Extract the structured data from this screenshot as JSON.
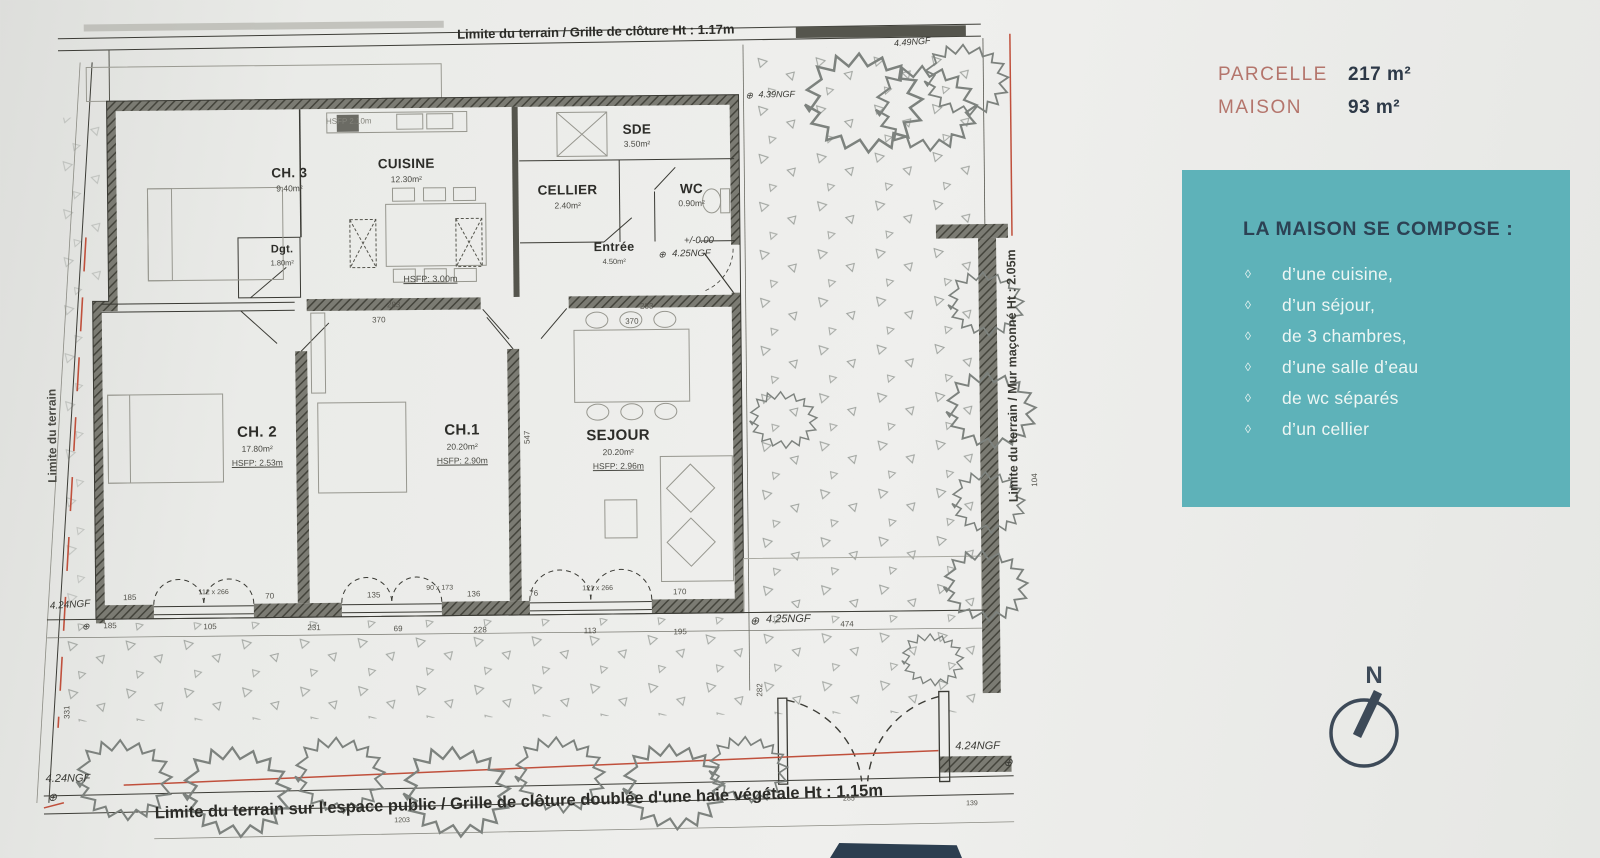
{
  "plan": {
    "boundary": {
      "top": "Limite du terrain / Grille de clôture Ht : 1.17m",
      "bottom": "Limite du terrain sur l'espace public / Grille de clôture doublée d'une haie végétale Ht : 1.15m",
      "left": "Limite du terrain",
      "right": "Limite du terrain / Mur maçonné Ht : 2.05m"
    },
    "rooms": [
      {
        "name": "CH. 3",
        "area": "9.40m²"
      },
      {
        "name": "Dgt.",
        "area": "1.80m²"
      },
      {
        "name": "CUISINE",
        "area": "12.30m²"
      },
      {
        "name": "CELLIER",
        "area": "2.40m²"
      },
      {
        "name": "SDE",
        "area": "3.50m²"
      },
      {
        "name": "WC",
        "area": "0.90m²"
      },
      {
        "name": "Entrée",
        "area": "4.50m²",
        "level": "+/-0.00",
        "ngf": "4.25NGF"
      },
      {
        "name": "CH. 2",
        "area": "17.80m²",
        "hsfp": "HSFP: 2.53m"
      },
      {
        "name": "CH.1",
        "area": "20.20m²",
        "hsfp": "HSFP: 2.90m"
      },
      {
        "name": "SEJOUR",
        "area": "20.20m²",
        "hsfp": "HSFP: 2.96m"
      }
    ],
    "hsfp_upper": "HSFP: 3.00m",
    "hsfp_kitchen": "HSFP 2.10m",
    "ngf_symbol": "⊕",
    "ngf_markers": [
      "4.49NGF",
      "4.39NGF",
      "4.25NGF",
      "4.24NGF",
      "4.24NGF",
      "4.24NGF"
    ],
    "dims": [
      "283",
      "370",
      "283",
      "370",
      "474",
      "185",
      "112 x 266",
      "70",
      "135",
      "90 x 173",
      "136",
      "76",
      "121 x 266",
      "170",
      "185",
      "105",
      "231",
      "69",
      "228",
      "113",
      "195",
      "1203",
      "285",
      "139",
      "282",
      "331",
      "547",
      "104"
    ]
  },
  "sidebar": {
    "stats": [
      {
        "label": "PARCELLE",
        "value": "217 m²"
      },
      {
        "label": "MAISON",
        "value": "93 m²"
      }
    ],
    "compose": {
      "title": "LA MAISON SE COMPOSE :",
      "bullet": "◊",
      "items": [
        "d’une cuisine,",
        "d’un séjour,",
        "de 3 chambres,",
        "d’une salle d’eau",
        "de wc séparés",
        "d’un cellier"
      ]
    },
    "compass": {
      "label": "N"
    }
  },
  "colors": {
    "teal": "#5eb2b9",
    "label_rose": "#b4756c",
    "navy": "#2d3947",
    "boundary_red": "#c0503c"
  }
}
